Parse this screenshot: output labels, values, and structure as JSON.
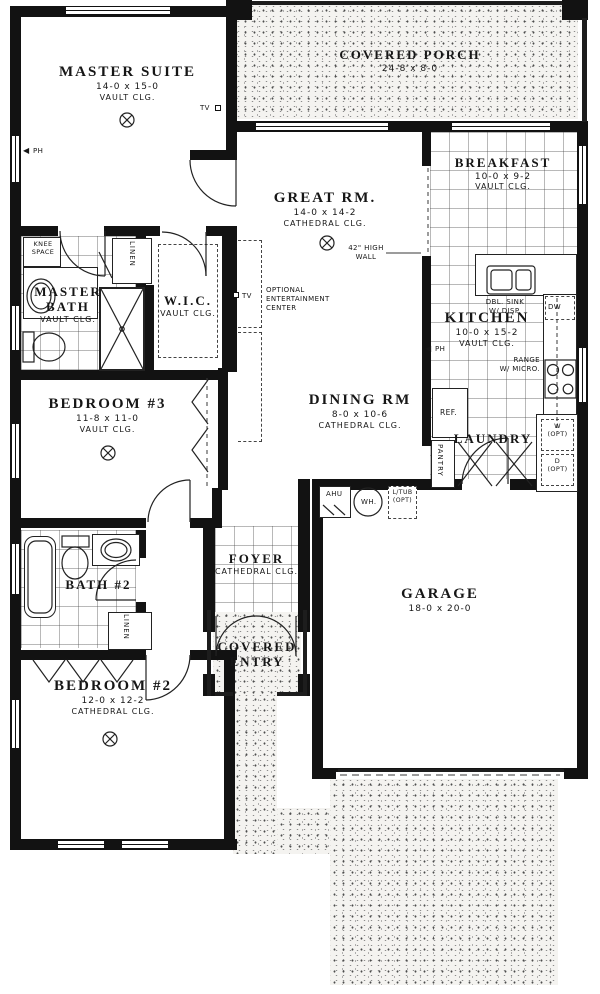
{
  "rooms": {
    "covered_porch": {
      "name": "COVERED PORCH",
      "dim": "24-8 x 8-0"
    },
    "master_suite": {
      "name": "MASTER SUITE",
      "dim": "14-0 x 15-0",
      "clg": "VAULT CLG."
    },
    "great_rm": {
      "name": "GREAT RM.",
      "dim": "14-0 x 14-2",
      "clg": "CATHEDRAL CLG."
    },
    "breakfast": {
      "name": "BREAKFAST",
      "dim": "10-0 x 9-2",
      "clg": "VAULT CLG."
    },
    "master_bath": {
      "name": "MASTER BATH",
      "clg": "VAULT CLG."
    },
    "wic": {
      "name": "W.I.C.",
      "clg": "VAULT CLG."
    },
    "kitchen": {
      "name": "KITCHEN",
      "dim": "10-0 x 15-2",
      "clg": "VAULT CLG."
    },
    "bedroom3": {
      "name": "BEDROOM #3",
      "dim": "11-8 x 11-0",
      "clg": "VAULT CLG."
    },
    "dining_rm": {
      "name": "DINING RM",
      "dim": "8-0 x 10-6",
      "clg": "CATHEDRAL CLG."
    },
    "laundry": {
      "name": "LAUNDRY"
    },
    "bath2": {
      "name": "BATH #2"
    },
    "foyer": {
      "name": "FOYER",
      "clg": "CATHEDRAL CLG."
    },
    "covered_entry": {
      "name": "COVERED ENTRY"
    },
    "garage": {
      "name": "GARAGE",
      "dim": "18-0 x 20-0"
    },
    "bedroom2": {
      "name": "BEDROOM #2",
      "dim": "12-0 x 12-2",
      "clg": "CATHEDRAL CLG."
    }
  },
  "notes": {
    "knee_1": "KNEE",
    "knee_2": "SPACE",
    "linen": "LINEN",
    "opt_1": "OPTIONAL",
    "opt_2": "ENTERTAINMENT",
    "opt_3": "CENTER",
    "high_wall_1": "42\" HIGH",
    "high_wall_2": "WALL",
    "dbl_sink_1": "DBL. SINK",
    "dbl_sink_2": "W/ DISP.",
    "dw": "DW",
    "range_1": "RANGE",
    "range_2": "W/ MICRO.",
    "ref": "REF.",
    "pantry": "PANTRY",
    "w_opt_1": "W",
    "d_opt_1": "D",
    "opt_paren": "(OPT)",
    "ahu": "AHU",
    "wh": "WH.",
    "ltub_1": "L/TUB",
    "ltub_2": "(OPT)",
    "tv": "TV",
    "ph": "PH",
    "arrow_left": "◀"
  }
}
